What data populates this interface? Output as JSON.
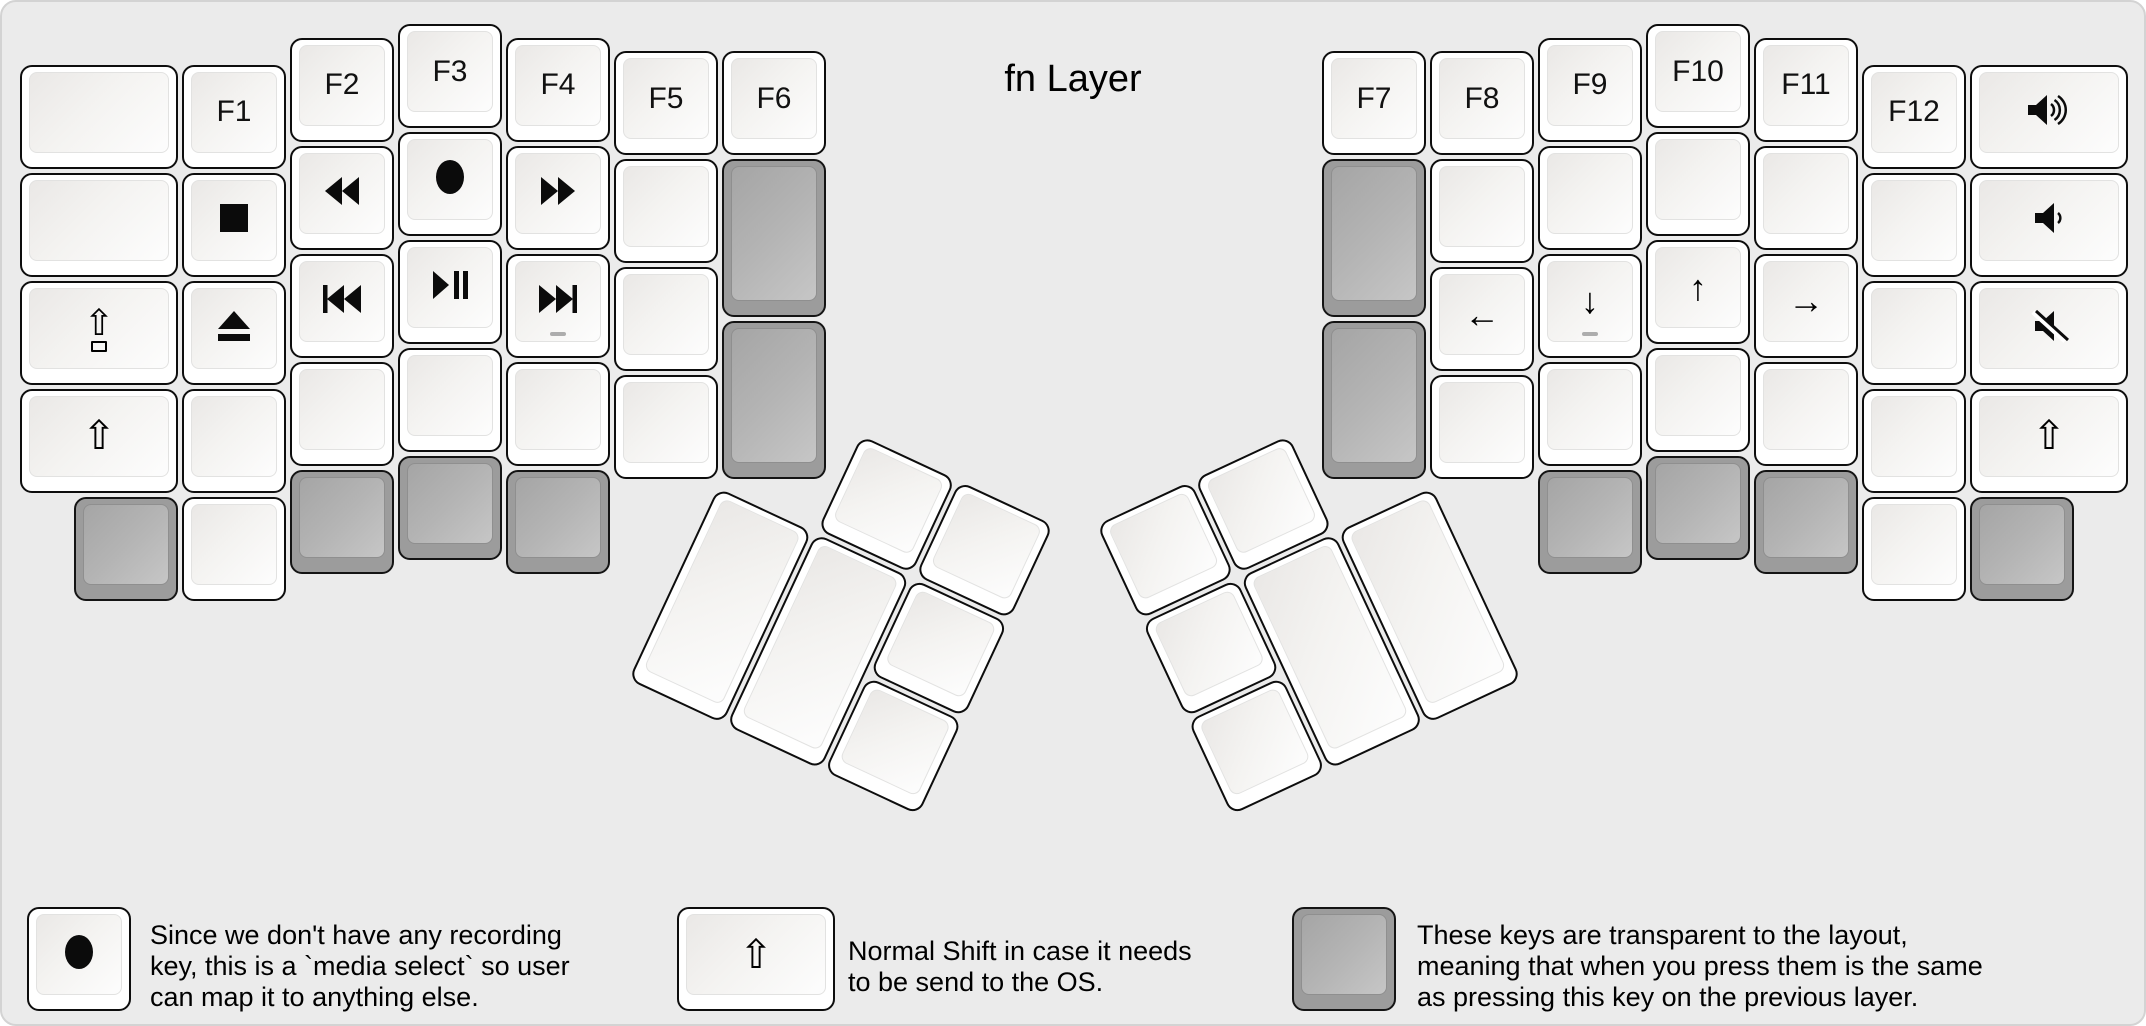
{
  "title": "fn Layer",
  "canvas": {
    "width": 2146,
    "height": 1026,
    "background": "#ebebeb",
    "border_color": "#d3d3d3"
  },
  "colors": {
    "key_border": "#0d0d0d",
    "white_key": "#ffffff",
    "transparent_key_gray": "#9c9c9c",
    "label": "#111111",
    "homing_dash": "#adadad"
  },
  "unit": 108,
  "left_half": {
    "x": 16,
    "y": 20,
    "keys": [
      {
        "x": 0,
        "y": 0.375,
        "w": 1.5
      },
      {
        "x": 0,
        "y": 1.375,
        "w": 1.5
      },
      {
        "x": 0,
        "y": 2.375,
        "w": 1.5,
        "icon": "caps-lock-icon"
      },
      {
        "x": 0,
        "y": 3.375,
        "w": 1.5,
        "icon": "shift-icon"
      },
      {
        "x": 1.5,
        "y": 0.375,
        "label": "F1"
      },
      {
        "x": 1.5,
        "y": 1.375,
        "icon": "stop-icon"
      },
      {
        "x": 1.5,
        "y": 2.375,
        "icon": "eject-icon"
      },
      {
        "x": 1.5,
        "y": 3.375
      },
      {
        "x": 2.5,
        "y": 0.125,
        "label": "F2"
      },
      {
        "x": 2.5,
        "y": 1.125,
        "icon": "rewind-icon"
      },
      {
        "x": 2.5,
        "y": 2.125,
        "icon": "prev-track-icon"
      },
      {
        "x": 2.5,
        "y": 3.125
      },
      {
        "x": 3.5,
        "y": 0,
        "label": "F3"
      },
      {
        "x": 3.5,
        "y": 1,
        "icon": "record-icon"
      },
      {
        "x": 3.5,
        "y": 2,
        "icon": "play-pause-icon"
      },
      {
        "x": 3.5,
        "y": 3
      },
      {
        "x": 4.5,
        "y": 0.125,
        "label": "F4"
      },
      {
        "x": 4.5,
        "y": 1.125,
        "icon": "fast-forward-icon"
      },
      {
        "x": 4.5,
        "y": 2.125,
        "icon": "next-track-icon",
        "homing": true
      },
      {
        "x": 4.5,
        "y": 3.125
      },
      {
        "x": 5.5,
        "y": 0.25,
        "label": "F5"
      },
      {
        "x": 5.5,
        "y": 1.25
      },
      {
        "x": 5.5,
        "y": 2.25
      },
      {
        "x": 5.5,
        "y": 3.25
      },
      {
        "x": 6.5,
        "y": 0.25,
        "label": "F6"
      },
      {
        "x": 6.5,
        "y": 1.25,
        "h": 1.5,
        "color": "gray"
      },
      {
        "x": 6.5,
        "y": 2.75,
        "h": 1.5,
        "color": "gray"
      },
      {
        "x": 0.5,
        "y": 4.375,
        "color": "gray"
      },
      {
        "x": 1.5,
        "y": 4.375
      },
      {
        "x": 2.5,
        "y": 4.125,
        "color": "gray"
      },
      {
        "x": 3.5,
        "y": 4,
        "color": "gray"
      },
      {
        "x": 4.5,
        "y": 4.125,
        "color": "gray"
      }
    ]
  },
  "right_half": {
    "x": 1318,
    "y": 20,
    "keys": [
      {
        "x": 0,
        "y": 0.25,
        "label": "F7"
      },
      {
        "x": 0,
        "y": 1.25,
        "h": 1.5,
        "color": "gray"
      },
      {
        "x": 0,
        "y": 2.75,
        "h": 1.5,
        "color": "gray"
      },
      {
        "x": 1,
        "y": 0.25,
        "label": "F8"
      },
      {
        "x": 1,
        "y": 1.25
      },
      {
        "x": 1,
        "y": 2.25,
        "icon": "arrow-left-icon"
      },
      {
        "x": 1,
        "y": 3.25
      },
      {
        "x": 2,
        "y": 0.125,
        "label": "F9"
      },
      {
        "x": 2,
        "y": 1.125
      },
      {
        "x": 2,
        "y": 2.125,
        "icon": "arrow-down-icon",
        "homing": true
      },
      {
        "x": 2,
        "y": 3.125
      },
      {
        "x": 3,
        "y": 0,
        "label": "F10"
      },
      {
        "x": 3,
        "y": 1
      },
      {
        "x": 3,
        "y": 2,
        "icon": "arrow-up-icon"
      },
      {
        "x": 3,
        "y": 3
      },
      {
        "x": 4,
        "y": 0.125,
        "label": "F11"
      },
      {
        "x": 4,
        "y": 1.125
      },
      {
        "x": 4,
        "y": 2.125,
        "icon": "arrow-right-icon"
      },
      {
        "x": 4,
        "y": 3.125
      },
      {
        "x": 5,
        "y": 0.375,
        "label": "F12"
      },
      {
        "x": 5,
        "y": 1.375
      },
      {
        "x": 5,
        "y": 2.375
      },
      {
        "x": 5,
        "y": 3.375
      },
      {
        "x": 6,
        "y": 0.375,
        "w": 1.5,
        "icon": "volume-up-icon"
      },
      {
        "x": 6,
        "y": 1.375,
        "w": 1.5,
        "icon": "volume-down-icon"
      },
      {
        "x": 6,
        "y": 2.375,
        "w": 1.5,
        "icon": "volume-mute-icon"
      },
      {
        "x": 6,
        "y": 3.375,
        "w": 1.5,
        "icon": "shift-icon"
      },
      {
        "x": 2,
        "y": 4.125,
        "color": "gray"
      },
      {
        "x": 3,
        "y": 4,
        "color": "gray"
      },
      {
        "x": 4,
        "y": 4.125,
        "color": "gray"
      },
      {
        "x": 5,
        "y": 4.375
      },
      {
        "x": 6,
        "y": 4.375,
        "color": "gray"
      }
    ]
  },
  "left_thumb": {
    "x": 715,
    "y": 483,
    "angle": 25,
    "keys": [
      {
        "x": 1,
        "y": -1
      },
      {
        "x": 2,
        "y": -1
      },
      {
        "x": 0,
        "y": 0,
        "h": 2
      },
      {
        "x": 1,
        "y": 0,
        "h": 2
      },
      {
        "x": 2,
        "y": 0
      },
      {
        "x": 2,
        "y": 1
      }
    ]
  },
  "right_thumb": {
    "x": 1431,
    "y": 483,
    "angle": -25,
    "keys": [
      {
        "x": -2,
        "y": -1
      },
      {
        "x": -3,
        "y": -1
      },
      {
        "x": -1,
        "y": 0,
        "h": 2
      },
      {
        "x": -2,
        "y": 0,
        "h": 2
      },
      {
        "x": -3,
        "y": 0
      },
      {
        "x": -3,
        "y": 1
      }
    ]
  },
  "legend": [
    {
      "key": {
        "icon": "record-icon",
        "color": "white",
        "w": 1
      },
      "key_x": 25,
      "text_x": 148,
      "text_y": 918,
      "lines": [
        "Since we don't have any recording",
        "key, this is a `media select` so user",
        "can map it to anything else."
      ]
    },
    {
      "key": {
        "icon": "shift-icon",
        "color": "white",
        "w": 1.5
      },
      "key_x": 675,
      "text_x": 846,
      "text_y": 934,
      "lines": [
        "Normal Shift in case it needs",
        "to be send to the OS."
      ]
    },
    {
      "key": {
        "icon": null,
        "color": "gray",
        "w": 1
      },
      "key_x": 1290,
      "text_x": 1415,
      "text_y": 918,
      "lines": [
        "These keys are transparent to the layout,",
        "meaning that when you press them is the same",
        "as pressing this key on the previous layer."
      ]
    }
  ]
}
